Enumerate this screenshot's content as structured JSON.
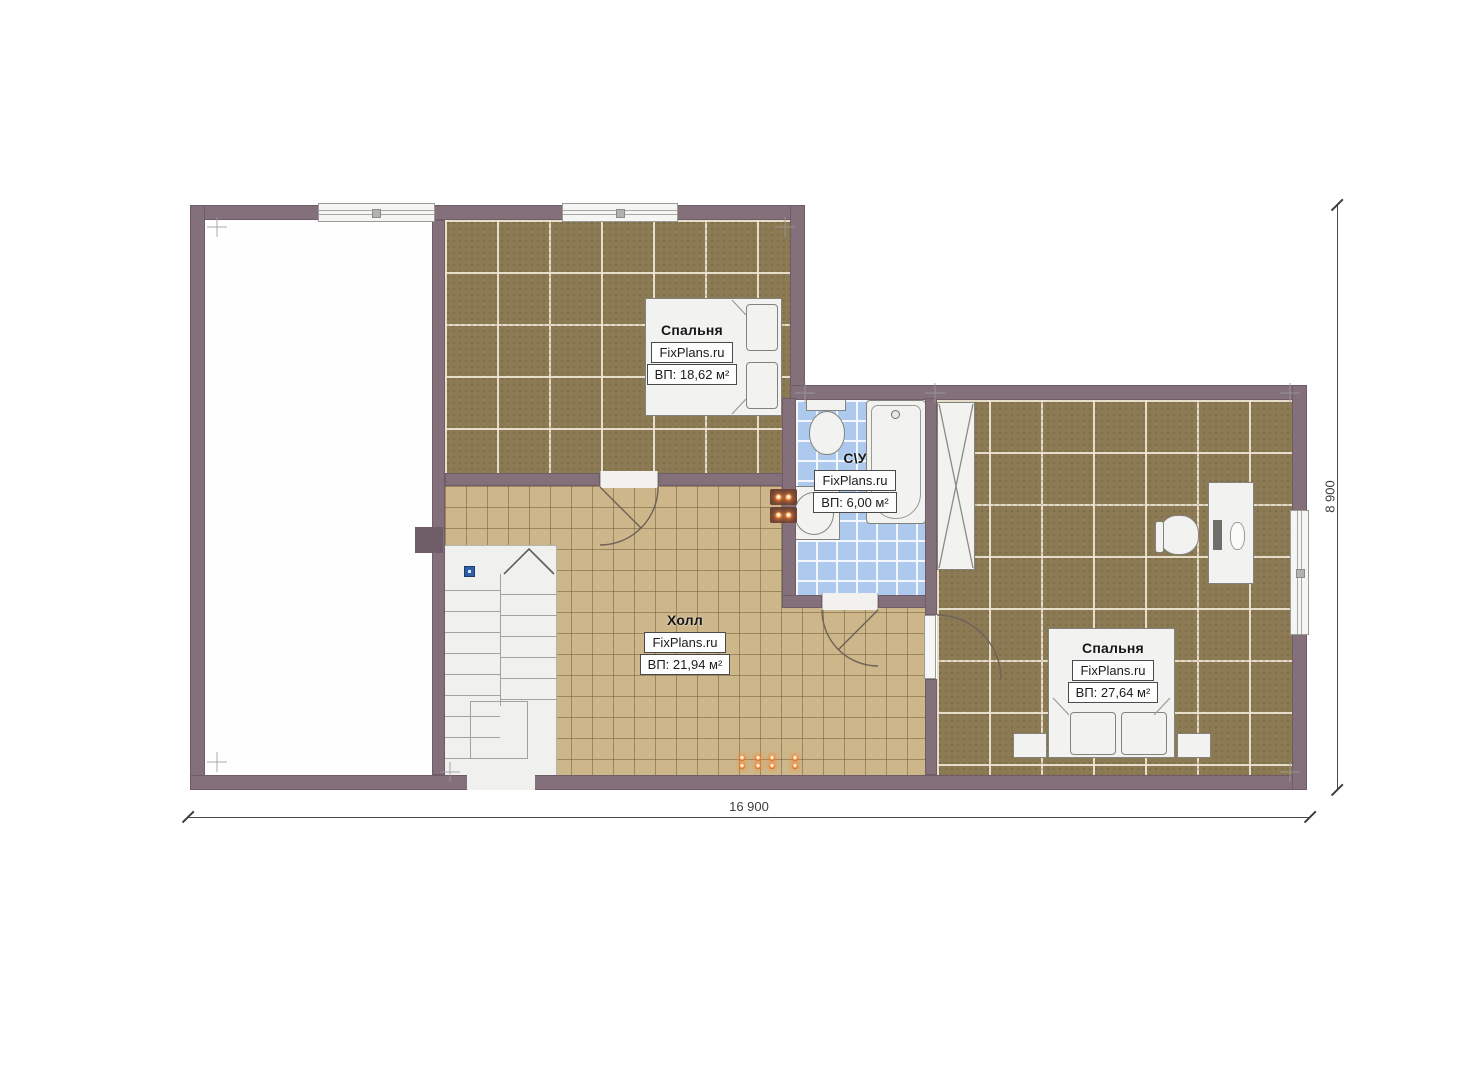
{
  "rooms": [
    {
      "id": "bedroom-1",
      "name": "Спальня",
      "brand": "FixPlans.ru",
      "area": "ВП: 18,62 м²"
    },
    {
      "id": "bathroom",
      "name": "С\\У",
      "brand": "FixPlans.ru",
      "area": "ВП: 6,00 м²"
    },
    {
      "id": "hall",
      "name": "Холл",
      "brand": "FixPlans.ru",
      "area": "ВП: 21,94 м²"
    },
    {
      "id": "bedroom-2",
      "name": "Спальня",
      "brand": "FixPlans.ru",
      "area": "ВП: 27,64 м²"
    }
  ],
  "dimensions": {
    "bottom": "16 900",
    "right": "8 900"
  },
  "colors": {
    "wall": "#84707a",
    "wall_dark": "#6e5d66",
    "floor_dark": "#8b7a54",
    "floor_tan": "#cdb78a",
    "bath": "#aec9ee",
    "fixture": "#f2f2f0",
    "fixture_line": "#83837e",
    "accent_orange": "#f07b28",
    "marker_blue": "#2f5fa8",
    "dim": "#4a4a4a"
  }
}
